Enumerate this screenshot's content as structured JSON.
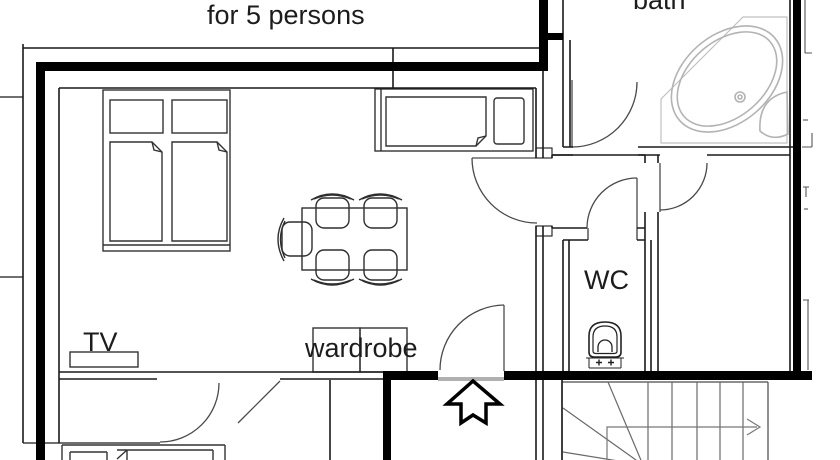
{
  "title": "apartment floor plan",
  "labels": {
    "capacity": "for 5 persons",
    "bath": "bath",
    "wc": "WC",
    "tv": "TV",
    "wardrobe": "wardrobe"
  },
  "symbols": [
    "twin-beds-icon",
    "single-bed-icon",
    "dining-table-icon",
    "chair-icon",
    "tv-icon",
    "wardrobe-icon",
    "corner-bathtub-icon",
    "toilet-icon",
    "stairs-icon",
    "door-swing-icon",
    "entrance-arrow-icon"
  ],
  "colors": {
    "background": "#ffffff",
    "wall": "#000000",
    "thin_line": "#1a1a1a",
    "door_line": "#4a4a4a",
    "furniture_line": "#333333",
    "tub_line": "#b3b3b3",
    "stairs_line": "#555555",
    "threshold": "#b0b0b0"
  }
}
